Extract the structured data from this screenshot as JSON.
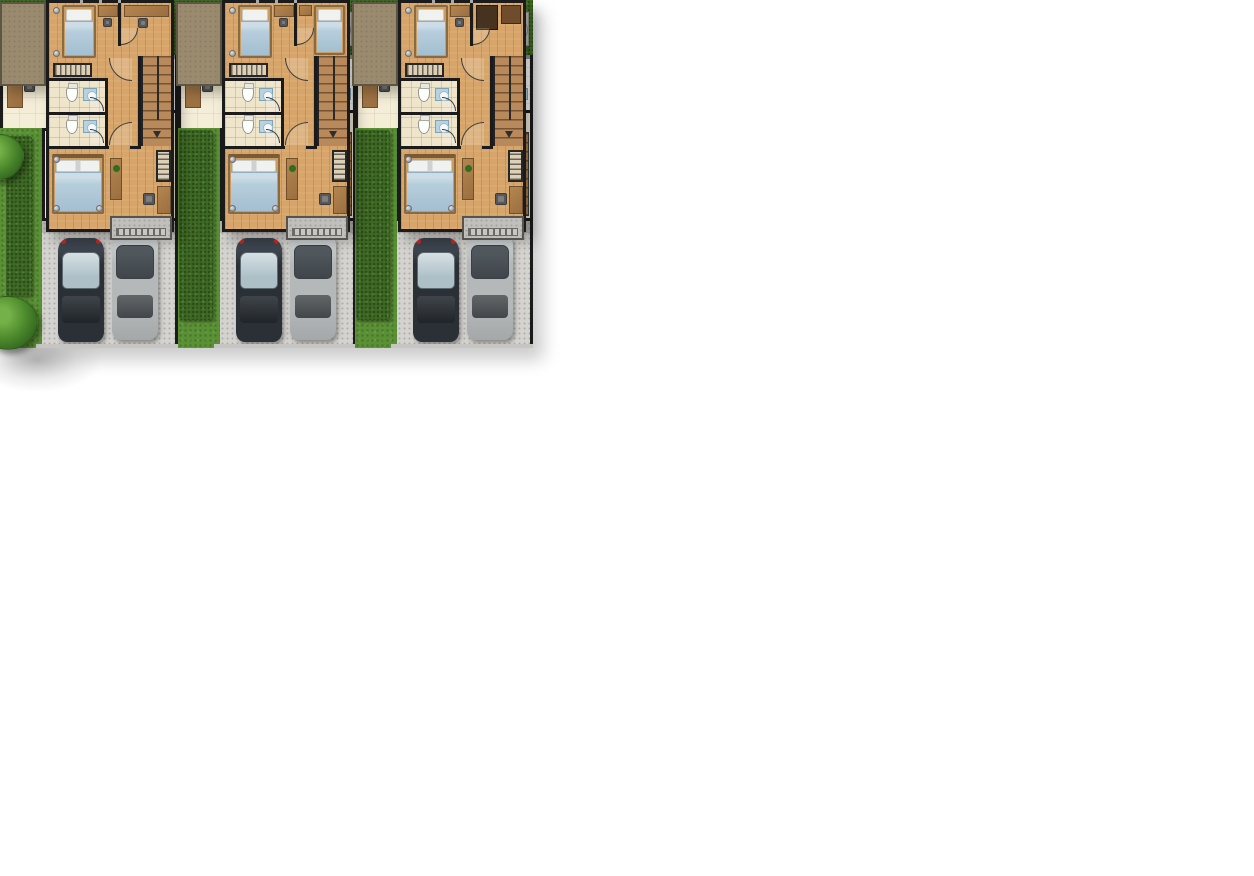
{
  "scene": {
    "type": "architectural-floor-plan-illustration",
    "background": "#ffffff",
    "plans": [
      {
        "id": "ground-floor-plan",
        "unit_count": 3
      },
      {
        "id": "upper-floor-plan",
        "unit_count": 3
      }
    ]
  },
  "colors": {
    "wall": "#1b1b1b",
    "cream_floor": "#f4edd7",
    "wood": "#a6794a",
    "wood_dark": "#6e4f2e",
    "hedge": "#3e6b23",
    "grass": "#5a9135",
    "tree_light": "#74b148",
    "tree_dark": "#2f611d",
    "patio_grey": "#c9c8c3",
    "parking_grey": "#d4d3cf",
    "porch_grey": "#b7b5b0",
    "bath_white": "#fbfbf8",
    "fixture_blue": "#b9d3de",
    "sofa_grey": "#ababab",
    "car_dark": "#2a3036",
    "car_dark_glass": "#adc0c7",
    "car_silver": "#b4b8b9",
    "car_silver_glass": "#3f454a",
    "taillight": "#cc2a24",
    "upper_wood": "#d7a569",
    "upper_tile": "#efe5cb",
    "roof_deck": "#9a8b6f",
    "bed_blue": "#b7cddc",
    "pillow_white": "#f0f2f0",
    "balcony_grey": "#c0bfbb",
    "plant_green": "#2f6d1f"
  },
  "ground_unit": {
    "rooms": [
      "backyard-terrace",
      "dining-area",
      "kitchen",
      "bathroom",
      "living-room",
      "staircase",
      "carport"
    ],
    "backyard_items": [
      "boundary-hedge",
      "round-patio-table",
      "paved-terrace",
      "utility-pad"
    ],
    "dining_items": [
      "work-desk",
      "desk-chair",
      "dining-table",
      "dining-chair",
      "dining-chair",
      "dining-chair",
      "dining-chair"
    ],
    "kitchen_items": [
      "counter-sink",
      "stove",
      "washing-machine"
    ],
    "bathroom_items": [
      "toilet",
      "wash-basin",
      "door-swing"
    ],
    "living_items": [
      "sofa",
      "side-table",
      "side-table",
      "coffee-table",
      "staircase",
      "door-swing"
    ],
    "carport_items": [
      "dark-car",
      "silver-car",
      "driveway"
    ],
    "landscape_items": [
      "separating-hedge",
      "side-lawn",
      "tree",
      "tree"
    ]
  },
  "upper_unit": {
    "rooms": [
      "bedroom-2",
      "study",
      "hallway",
      "bathroom-1",
      "bathroom-2",
      "staircase",
      "master-bedroom",
      "balcony",
      "roof-deck"
    ],
    "bedroom_2_items": [
      "single-bed",
      "desk",
      "chair",
      "wardrobe"
    ],
    "bathroom_items": [
      "toilet",
      "vanity",
      "toilet",
      "vanity",
      "door-swing",
      "door-swing"
    ],
    "hallway_items": [
      "door-swing",
      "door-swing"
    ],
    "staircase_items": [
      "steps",
      "handrail",
      "down-arrow"
    ],
    "master_bedroom_items": [
      "double-bed",
      "bench",
      "plant",
      "desk",
      "desk-chair",
      "closet"
    ],
    "balcony_items": [
      "railing"
    ]
  },
  "upper_unit_variants": [
    {
      "study_items": [
        "desk",
        "desk-chair"
      ]
    },
    {
      "study_items": [
        "single-bed",
        "desk"
      ]
    },
    {
      "study_items": [
        "wardrobe",
        "cabinet"
      ]
    }
  ]
}
